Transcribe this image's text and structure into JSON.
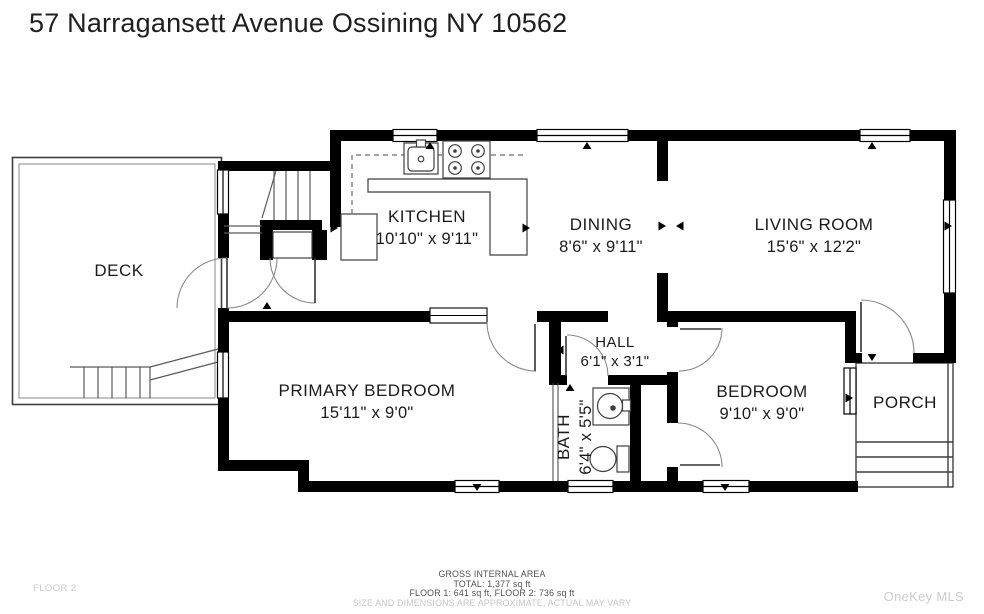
{
  "title": "57 Narragansett Avenue Ossining NY 10562",
  "rooms": {
    "deck": {
      "name": "DECK",
      "dims": ""
    },
    "kitchen": {
      "name": "KITCHEN",
      "dims": "10'10\" x 9'11\""
    },
    "dining": {
      "name": "DINING",
      "dims": "8'6\" x 9'11\""
    },
    "living": {
      "name": "LIVING ROOM",
      "dims": "15'6\" x 12'2\""
    },
    "hall": {
      "name": "HALL",
      "dims": "6'1\" x 3'1\""
    },
    "primary": {
      "name": "PRIMARY BEDROOM",
      "dims": "15'11\" x 9'0\""
    },
    "bath": {
      "name": "BATH",
      "dims": "6'4\" x 5'5\""
    },
    "bedroom": {
      "name": "BEDROOM",
      "dims": "9'10\" x 9'0\""
    },
    "porch": {
      "name": "PORCH",
      "dims": ""
    }
  },
  "footer": {
    "floor_label": "FLOOR 2",
    "area_title": "GROSS INTERNAL AREA",
    "area_total": "TOTAL: 1,377 sq ft",
    "area_floors": "FLOOR 1: 641 sq ft, FLOOR 2: 736 sq ft",
    "disclaimer": "SIZE AND DIMENSIONS ARE APPROXIMATE, ACTUAL MAY VARY",
    "watermark": "OneKey MLS"
  },
  "colors": {
    "wall": "#000000",
    "line": "#3f3f3f",
    "arc": "#8a8a8a",
    "text": "#1b1b1b",
    "muted": "#c9c9c9"
  }
}
